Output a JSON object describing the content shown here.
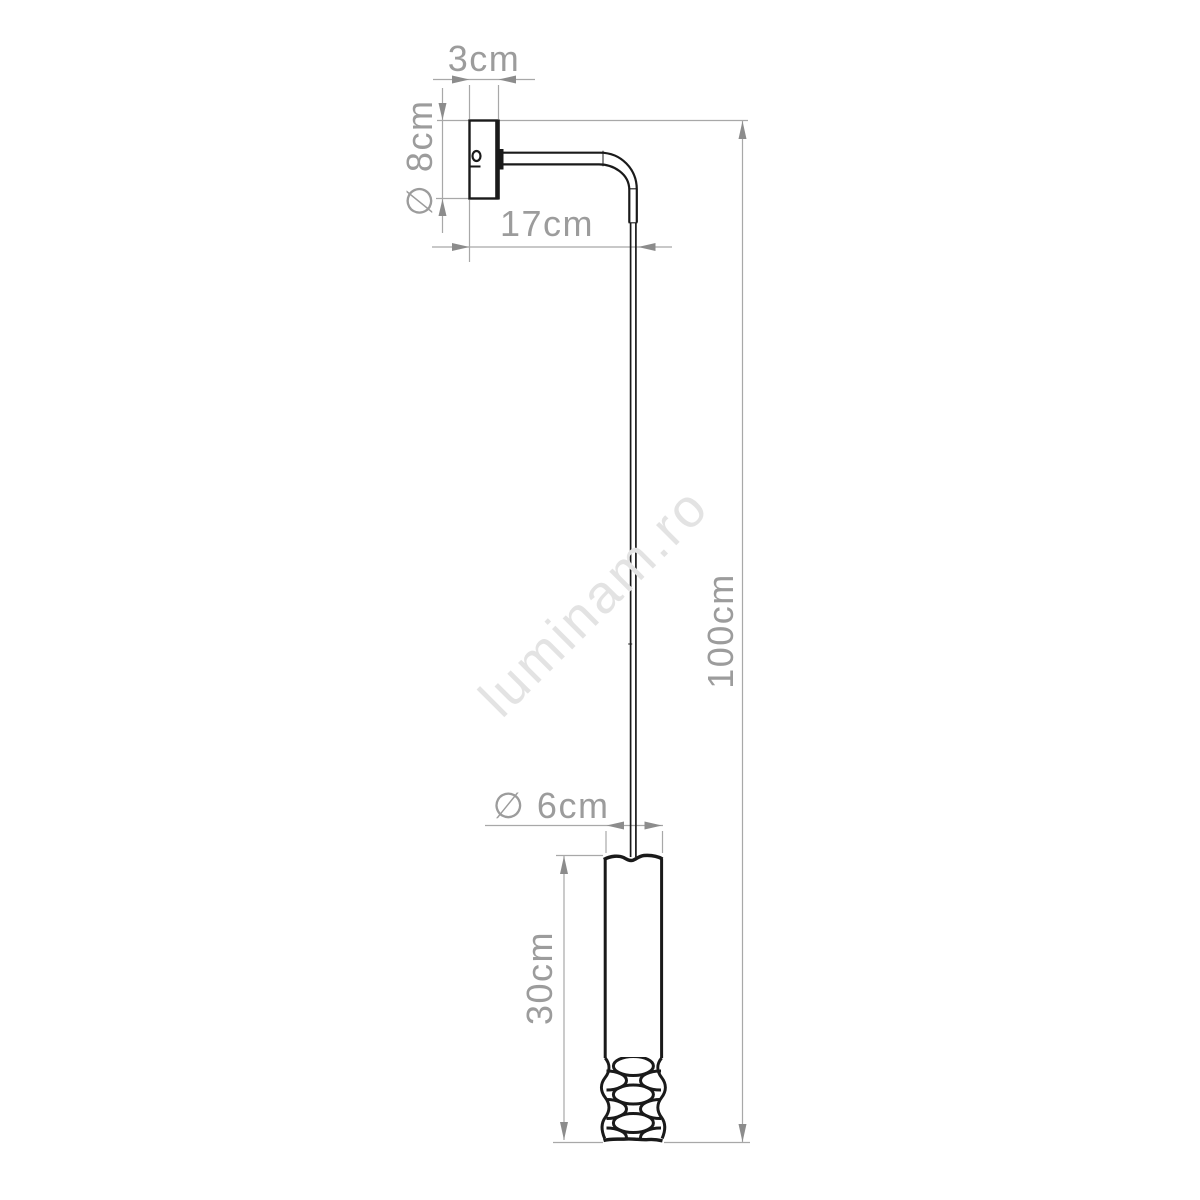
{
  "drawing": {
    "title": "wall-lamp-dimension-drawing",
    "watermark": "luminam.ro",
    "labels": {
      "plate_width": "3cm",
      "plate_diameter": "∅ 8cm",
      "arm_length": "17cm",
      "shade_diameter": "∅ 6cm",
      "shade_height": "30cm",
      "drop_height": "100cm"
    },
    "colors": {
      "background": "#ffffff",
      "object_line": "#1a1a1a",
      "dimension_line": "#a8a8a8",
      "dimension_arrow": "#8c8c8c",
      "dimension_text": "#9c9c9c",
      "watermark_text": "#e3e3e3"
    }
  }
}
